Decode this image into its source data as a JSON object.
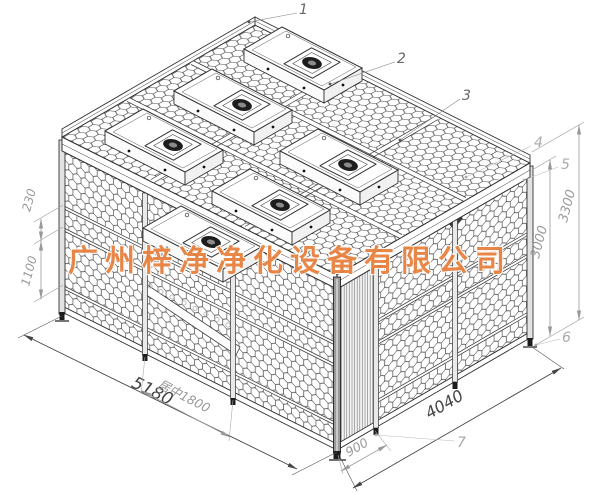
{
  "title": "clean-booth-isometric-technical-drawing",
  "watermark": {
    "text": "广州梓净净化设备有限公司",
    "color": "#e8823f"
  },
  "dimensions": {
    "d230": "230",
    "d1100": "1100",
    "d3000": "3000",
    "d3300": "3300",
    "d5180": "5180",
    "d1800": "居中1800",
    "d900": "900",
    "d4040": "4040"
  },
  "callouts": {
    "c1": "1",
    "c2": "2",
    "c3": "3",
    "c4": "4",
    "c5": "5",
    "c6": "6",
    "c7": "7"
  },
  "colors": {
    "line": "#333333",
    "mesh": "#4a4a4a",
    "dim_gray": "#999999",
    "dim_dark": "#444444",
    "watermark_orange": "#e8823f",
    "background": "#ffffff"
  }
}
